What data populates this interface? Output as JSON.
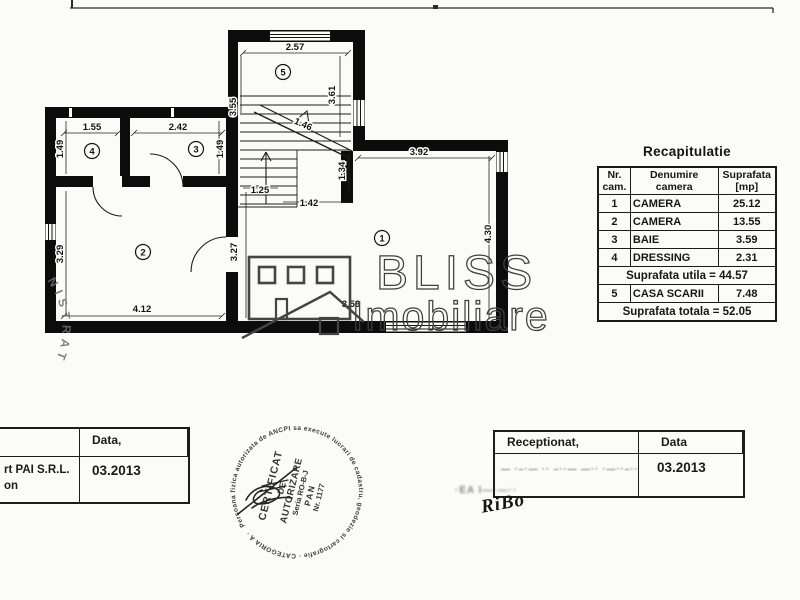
{
  "colors": {
    "paper": "#fbfbfa",
    "ink": "#0c0c0c",
    "logo_gray": "#3f3f3f",
    "stamp_ink": "#2d2d2d"
  },
  "plan": {
    "rooms": [
      "1",
      "2",
      "3",
      "4",
      "5"
    ],
    "dims": [
      "2.57",
      "3.55",
      "3.61",
      "1.55",
      "2.42",
      "1.49",
      "1.49",
      "3.29",
      "3.27",
      "4.12",
      "3.92",
      "4.30",
      "1.34",
      "1.25",
      "1.42",
      "1.46",
      "3.59"
    ]
  },
  "recap": {
    "title": "Recapitulatie",
    "col_nr": "Nr. cam.",
    "col_name": "Denumire camera",
    "col_area": "Suprafata [mp]",
    "rows": [
      {
        "nr": "1",
        "name": "CAMERA",
        "area": "25.12"
      },
      {
        "nr": "2",
        "name": "CAMERA",
        "area": "13.55"
      },
      {
        "nr": "3",
        "name": "BAIE",
        "area": "3.59"
      },
      {
        "nr": "4",
        "name": "DRESSING",
        "area": "2.31"
      }
    ],
    "subtotal": "Suprafata utila = 44.57",
    "stair_row": {
      "nr": "5",
      "name": "CASA SCARII",
      "area": "7.48"
    },
    "total": "Suprafata totala = 52.05"
  },
  "logo": {
    "title": "BLISS",
    "subtitle": "Imobiliare"
  },
  "round_stamp": {
    "ring": "Persoana fizica autorizata de ANCPI sa execute lucrari de cadastru, geodezie si cartografie · CATEGORIA A ·",
    "line1": "CERTIFICAT",
    "line2": "DE",
    "line3": "AUTORIZARE",
    "line4": "Seria RO-B-J",
    "line5": "PAN",
    "line6": "Nr. 1177"
  },
  "edge_stamp": {
    "text": "NISTRAT"
  },
  "left_box": {
    "firm_line1": "rt PAI S.R.L.",
    "firm_line2": "on",
    "date_label": "Data,",
    "date_value": "03.2013"
  },
  "right_box": {
    "label": "Receptionat,",
    "date_label": "Data",
    "date_value": "03.2013",
    "smudge": "— ·–·— ·· –··—  —·· ·—··–··—· a il I-JV",
    "under_smudge": "·EA I—·—··",
    "signature": "RiBo"
  }
}
